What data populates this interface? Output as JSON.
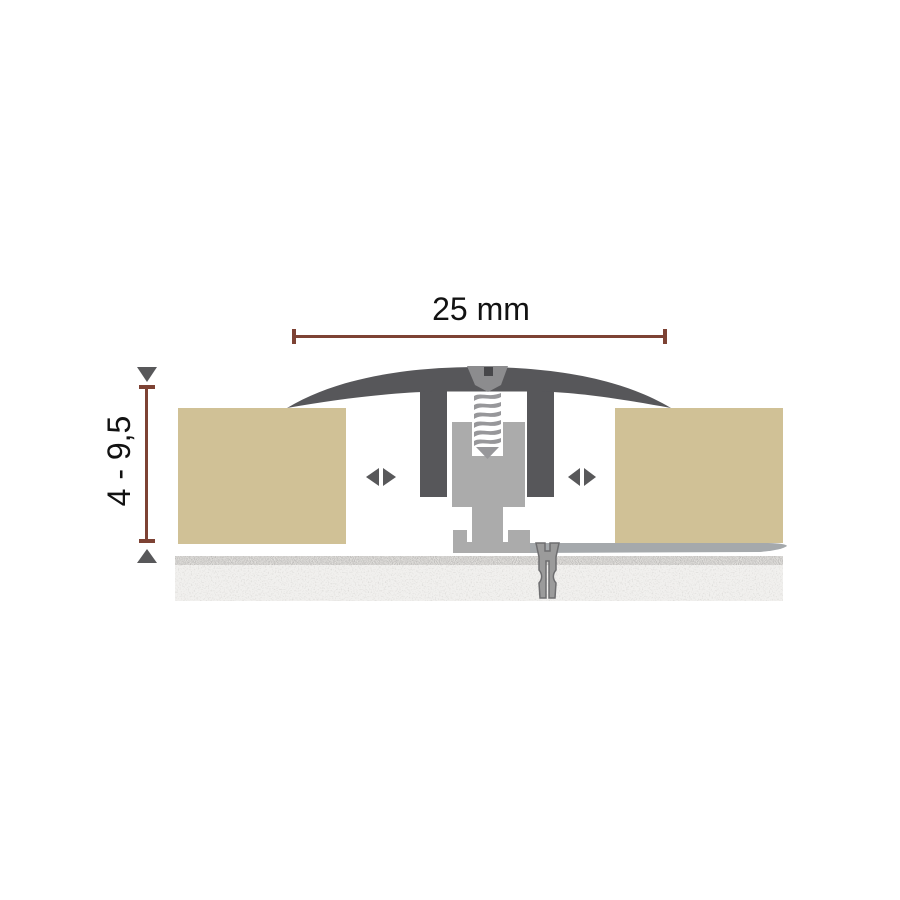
{
  "diagram": {
    "dimensions": {
      "width": {
        "label": "25 mm"
      },
      "height": {
        "label": "4 - 9,5"
      }
    },
    "icons": {
      "height_arrow_top": "triangle-down",
      "height_arrow_bottom": "triangle-up",
      "expansion_arrows_left": "left-right-triangle-pair",
      "expansion_arrows_right": "left-right-triangle-pair"
    },
    "colors": {
      "dimension_line": "#7d4234",
      "marker": "#58585a",
      "profile_dark": "#57575a",
      "profile_light": "#ababab",
      "screw": "#8c8c8e",
      "screw_slot": "#47474a",
      "thread": "#97979a",
      "floor": "#d0c196",
      "rail": "#a5a9ac",
      "anchor": "#9b9b9b",
      "anchor_outline": "#6e6e70",
      "subfloor": "#f1f0ee",
      "subfloor_band": "#d8d7d3",
      "text": "#121212",
      "background": "#ffffff"
    }
  }
}
